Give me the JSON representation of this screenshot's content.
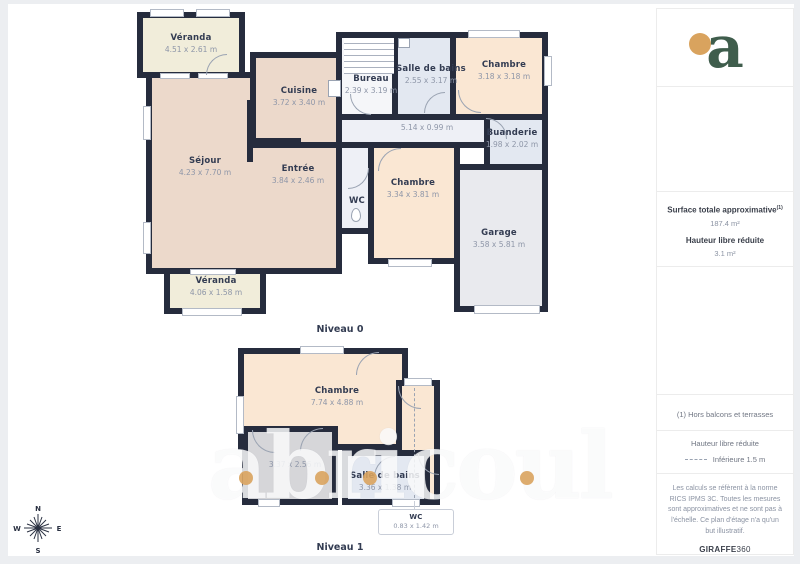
{
  "floor0": {
    "label": "Niveau 0",
    "corridor_dims": "5.14 x 0.99 m",
    "rooms": [
      {
        "name": "Véranda",
        "dims": "4.51 x 2.61 m"
      },
      {
        "name": "Cuisine",
        "dims": "3.72 x 3.40 m"
      },
      {
        "name": "Bureau",
        "dims": "2.39 x 3.19 m"
      },
      {
        "name": "Salle de bains",
        "dims": "2.55 x 3.17 m"
      },
      {
        "name": "Chambre",
        "dims": "3.18 x 3.18 m"
      },
      {
        "name": "Séjour",
        "dims": "4.23 x 7.70 m"
      },
      {
        "name": "Entrée",
        "dims": "3.84 x 2.46 m"
      },
      {
        "name": "WC",
        "dims": ""
      },
      {
        "name": "Chambre",
        "dims": "3.34 x 3.81 m"
      },
      {
        "name": "Buanderie",
        "dims": "1.98 x 2.02 m"
      },
      {
        "name": "Garage",
        "dims": "3.58 x 5.81 m"
      },
      {
        "name": "Véranda",
        "dims": "4.06 x 1.58 m"
      }
    ]
  },
  "floor1": {
    "label": "Niveau 1",
    "rooms": [
      {
        "name": "Chambre",
        "dims": "7.74 x 4.88 m"
      },
      {
        "name": "",
        "dims": "3.37 x 2.56 m"
      },
      {
        "name": "Salle de bains",
        "dims": "3.36 x 1.38 m"
      }
    ],
    "wc_callout": {
      "name": "WC",
      "dims": "0.83 x 1.42 m"
    }
  },
  "sidebar": {
    "logo_letter": "a",
    "surface_title": "Surface totale approximative",
    "surface_sup": "(1)",
    "surface_value": "187.4 m²",
    "height_title": "Hauteur libre réduite",
    "height_value": "3.1 m²",
    "note": "(1) Hors balcons et terrasses",
    "legend_title": "Hauteur libre réduite",
    "legend_item": "Inférieure 1.5 m",
    "legal": "Les calculs se réfèrent à la norme RICS IPMS 3C. Toutes les mesures sont approximatives et ne sont pas à l'échelle. Ce plan d'étage n'a qu'un but illustratif.",
    "brand": "GIRAFFE",
    "brand_suffix": "360"
  },
  "compass": {
    "n": "N",
    "s": "S",
    "e": "E",
    "w": "W"
  },
  "watermark": {
    "text": "abricoul"
  },
  "colors": {
    "wall": "#262c3d",
    "accent": "#d9a35e",
    "logo_green": "#3f5d4c",
    "peach": "#fae7d3",
    "salmon": "#ecd9cb",
    "cream": "#f1edda",
    "bath": "#e3e8f1"
  }
}
